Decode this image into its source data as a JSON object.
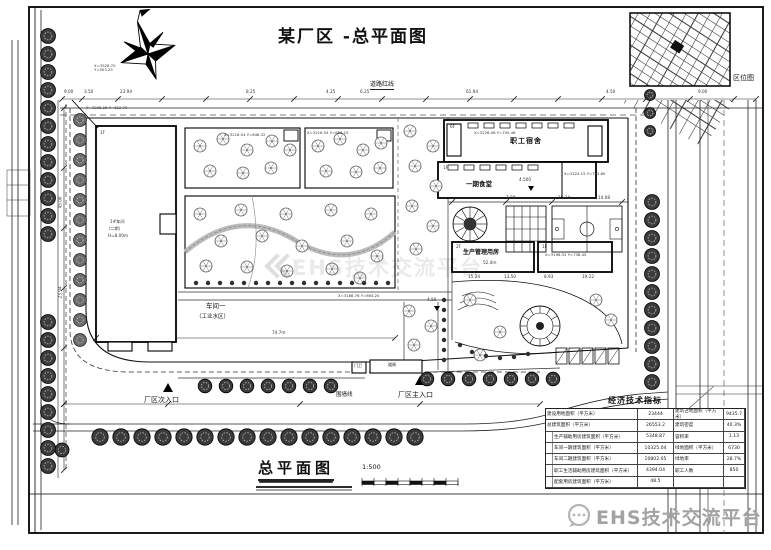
{
  "sheet": {
    "title": "某厂区 -总平面图",
    "plan_title": "总平面图",
    "scale": "1:500",
    "location_map_label": "区位图",
    "watermark": "EHS技术交流平台"
  },
  "labels": {
    "road_redline": "道路红线",
    "dorm": "职工宿舍",
    "canteen": "一期食堂",
    "mgmt": "生产管理用房",
    "mgmt_dim": "52.4m",
    "workshop": "车间一",
    "workshop_sub": "（工业水区）",
    "workshop_dim": "74.7m",
    "main_gate": "厂区主入口",
    "side_gate": "厂区次入口",
    "fence": "围墙线",
    "guard": "门卫",
    "gate_bar": "道闸",
    "elev1": "4.500",
    "elev2": "4.50",
    "b1_floor": "1F",
    "b1_note1": "1#车间",
    "b1_note2": "（二期）",
    "b1_note3": "H=8.00m",
    "dorm_floor": "6F",
    "canteen_floor": "1F",
    "mgmt_floor": "2F",
    "annex_floor": "1F"
  },
  "coords": [
    "X=3528.70 Y=503.25",
    "X=3208.25 Y=612.70",
    "X=3216.54 Y=648.32",
    "X=3216.54 Y=686.15",
    "X=3226.08 Y=705.46",
    "X=3224.15 Y=742.60",
    "X=3196.32 Y=738.45",
    "X=3188.76 Y=664.20"
  ],
  "dims_top": [
    "9.00",
    "3.50",
    "23.94",
    "8.25",
    "4.25",
    "6.25",
    "61.94",
    "4.50",
    "9.00"
  ],
  "dims_left": [
    "45.00",
    "23.94"
  ],
  "dims_mid": [
    "7.88",
    "15.24",
    "14.08"
  ],
  "dims_row": [
    "15.24",
    "13.50",
    "8.93",
    "19.22"
  ],
  "table": {
    "title": "经济技术指标",
    "group_label": "其中",
    "rows": [
      [
        "建设用地面积（平方米）",
        "23444",
        "建筑占地面积（平方米）",
        "9435.7"
      ],
      [
        "总建筑面积（平方米）",
        "26553.2",
        "建筑密度",
        "40.3%"
      ],
      [
        "生产辅助用房建筑面积（平方米）",
        "5348.87",
        "容积率",
        "1.13"
      ],
      [
        "车间一期建筑面积（平方米）",
        "10325.04",
        "绿地面积（平方米）",
        "6730"
      ],
      [
        "车间二期建筑面积（平方米）",
        "10802.05",
        "绿地率",
        "28.7%"
      ],
      [
        "职工生活辅助用房建筑面积（平方米）",
        "4394.04",
        "职工人数",
        "850"
      ],
      [
        "配套用房建筑面积（平方米）",
        "48.5",
        "",
        ""
      ]
    ]
  }
}
